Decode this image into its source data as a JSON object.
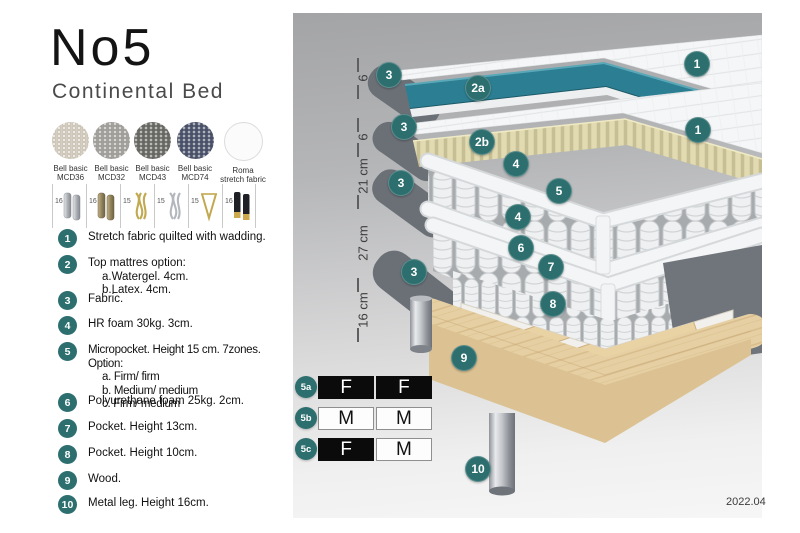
{
  "page": {
    "title": "No5",
    "subtitle": "Continental Bed",
    "edition": "2022.04"
  },
  "swatches": [
    {
      "line1": "Bell basic",
      "line2": "MCD36",
      "color": "#d6cec0"
    },
    {
      "line1": "Bell basic",
      "line2": "MCD32",
      "color": "#a3a19c"
    },
    {
      "line1": "Bell basic",
      "line2": "MCD43",
      "color": "#686864"
    },
    {
      "line1": "Bell basic",
      "line2": "MCD74",
      "color": "#49516b"
    },
    {
      "line1": "Roma",
      "line2": "stretch fabric",
      "color": "#fbfbfb"
    }
  ],
  "legs": [
    {
      "count": "16",
      "style": "cylinder-silver"
    },
    {
      "count": "16",
      "style": "cylinder-bronze"
    },
    {
      "count": "15",
      "style": "twist-gold"
    },
    {
      "count": "15",
      "style": "twist-silver"
    },
    {
      "count": "15",
      "style": "hairpin-gold"
    },
    {
      "count": "16",
      "style": "cylinder-black-gold"
    }
  ],
  "list": {
    "items": [
      {
        "num": "1",
        "text": "Stretch fabric quilted with wadding.",
        "sub": []
      },
      {
        "num": "2",
        "text": "Top mattres option:",
        "sub": [
          "a.Watergel. 4cm.",
          "b.Latex. 4cm."
        ]
      },
      {
        "num": "3",
        "text": "Fabric.",
        "sub": []
      },
      {
        "num": "4",
        "text": "HR foam 30kg. 3cm.",
        "sub": []
      },
      {
        "num": "5",
        "text": "Micropocket. Height 15 cm. 7zones. Option:",
        "sub": [
          "a. Firm/ firm",
          "b. Medium/ medium",
          "c. Firm/ medium"
        ]
      },
      {
        "num": "6",
        "text": "Polyurethane foam 25kg. 2cm.",
        "sub": []
      },
      {
        "num": "7",
        "text": "Pocket. Height 13cm.",
        "sub": []
      },
      {
        "num": "8",
        "text": "Pocket. Height 10cm.",
        "sub": []
      },
      {
        "num": "9",
        "text": "Wood.",
        "sub": []
      },
      {
        "num": "10",
        "text": "Metal leg. Height 16cm.",
        "sub": []
      }
    ]
  },
  "diagram": {
    "ruler": [
      "6",
      "6",
      "21 cm",
      "27 cm",
      "16 cm"
    ],
    "badges": {
      "b1a": "1",
      "b3a": "3",
      "b2a": "2a",
      "b3b": "3",
      "b1b": "1",
      "b2b": "2b",
      "b4a": "4",
      "b3c": "3",
      "b5": "5",
      "b4b": "4",
      "b6": "6",
      "b7": "7",
      "b3d": "3",
      "b8": "8",
      "b9": "9",
      "b10": "10"
    },
    "colors": {
      "badge": "#2d6f6f",
      "watergel": "#2c7f93",
      "slats": "#ded7ad",
      "wood": "#e6d0a3",
      "frame_gray": "#6b7077"
    }
  },
  "firmness": {
    "rows": [
      {
        "id": "5a",
        "cells": [
          {
            "text": "F",
            "tone": "dark"
          },
          {
            "text": "F",
            "tone": "dark"
          }
        ]
      },
      {
        "id": "5b",
        "cells": [
          {
            "text": "M",
            "tone": "light"
          },
          {
            "text": "M",
            "tone": "light"
          }
        ]
      },
      {
        "id": "5c",
        "cells": [
          {
            "text": "F",
            "tone": "dark"
          },
          {
            "text": "M",
            "tone": "light"
          }
        ]
      }
    ]
  }
}
